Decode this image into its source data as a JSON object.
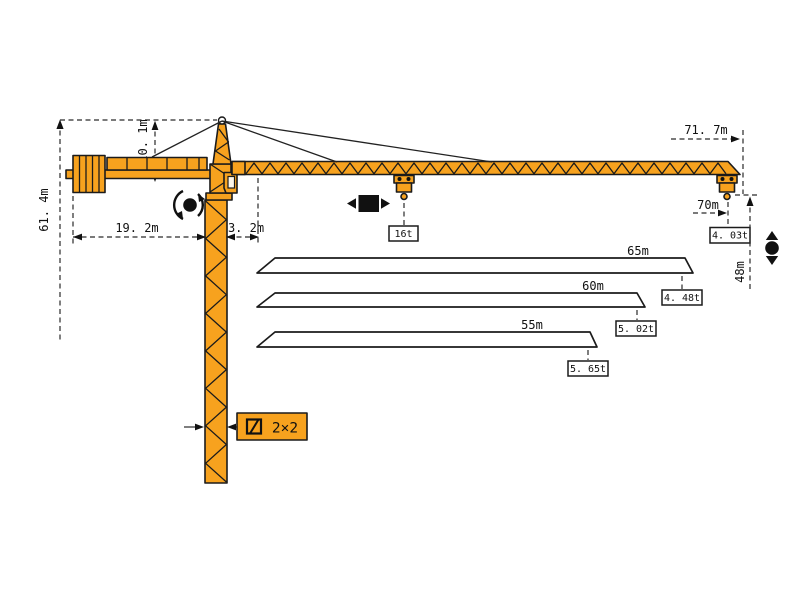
{
  "title": "Tower crane working range and load diagram",
  "colors": {
    "crane_orange": "#F7A21E",
    "outline_black": "#1b1b1b",
    "background": "#ffffff"
  },
  "dimensions": {
    "overall_height": "61. 4m",
    "tower_head_height": "10. 1m",
    "counter_jib_radius": "19. 2m",
    "rear_offset": "3. 2m",
    "max_working_radius": "71. 7m",
    "tip_radius": "70m",
    "hook_height": "48m",
    "mast_section": "2×2"
  },
  "loads": {
    "max_load": "16t",
    "tip_load_70m": "4. 03t"
  },
  "jib_variants": [
    {
      "length": "65m",
      "tip_load": "4. 48t"
    },
    {
      "length": "60m",
      "tip_load": "5. 02t"
    },
    {
      "length": "55m",
      "tip_load": "5. 65t"
    }
  ],
  "symbols": {
    "slewing": "slewing-rotation",
    "trolley": "trolley-travel",
    "hoisting": "hook-up-down",
    "mast_section": "square-section"
  }
}
